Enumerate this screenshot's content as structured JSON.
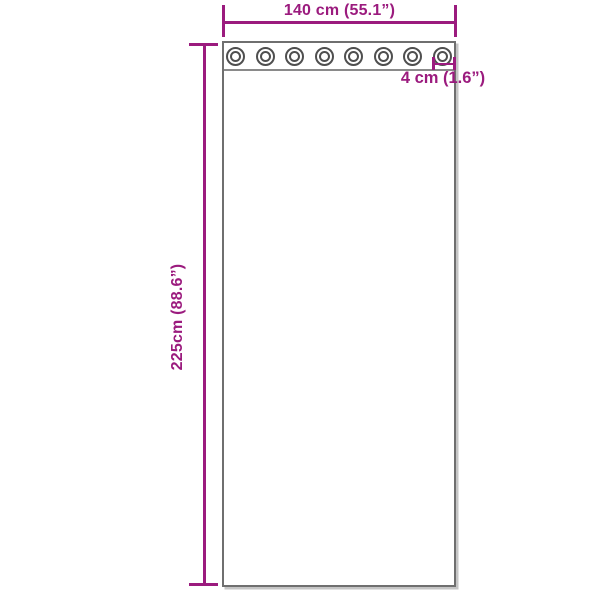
{
  "colors": {
    "dimension": "#9b1b7e",
    "outline": "#6f6f6f",
    "band-line": "#8a8a8a",
    "grommet": "#4f4f4f",
    "background": "#ffffff"
  },
  "diagram": {
    "product": "curtain-with-grommets",
    "width_label": "140 cm (55.1”)",
    "height_label": "225cm (88.6”)",
    "grommet_size_label": "4 cm (1.6”)",
    "grommet_count": 8
  }
}
